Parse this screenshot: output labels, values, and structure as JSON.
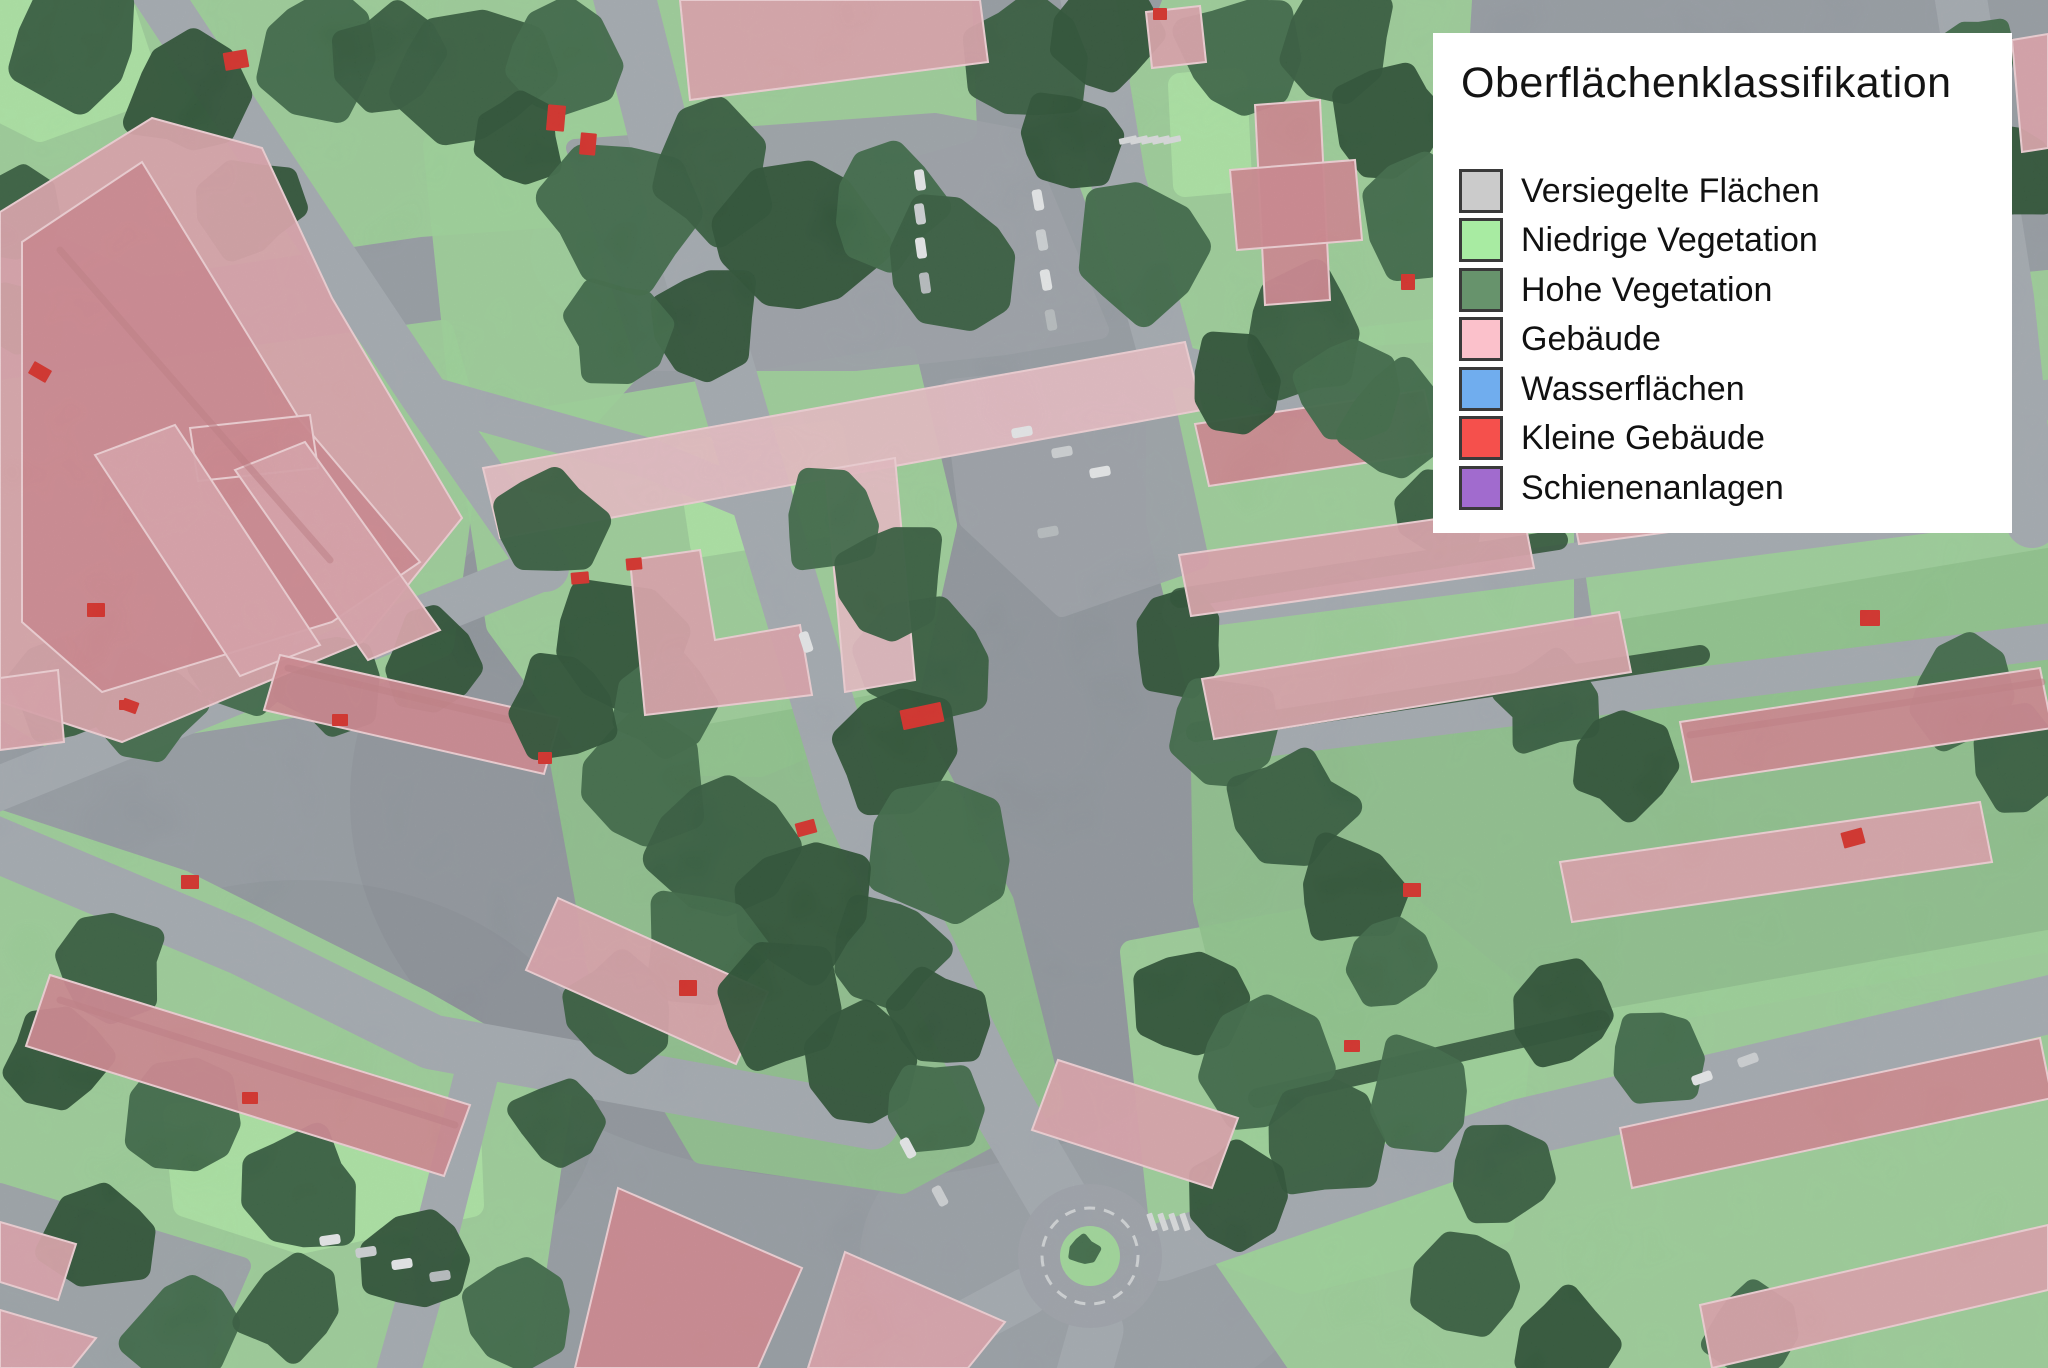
{
  "legend": {
    "title": "Oberflächenklassifikation",
    "items": [
      {
        "label": "Versiegelte Flächen",
        "color": "#CBCBCB"
      },
      {
        "label": "Niedrige Vegetation",
        "color": "#A8EBA2"
      },
      {
        "label": "Hohe Vegetation",
        "color": "#67936C"
      },
      {
        "label": "Gebäude",
        "color": "#FBC1CB"
      },
      {
        "label": "Wasserflächen",
        "color": "#70ADEE"
      },
      {
        "label": "Kleine Gebäude",
        "color": "#F5504C"
      },
      {
        "label": "Schienenanlagen",
        "color": "#A16BCE"
      }
    ]
  },
  "map": {
    "type": "landcover-classification-overlay",
    "class_colors": {
      "sealed_base": "#949BA2",
      "road": "#A3A9AF",
      "plaza": "#9CA2A8",
      "low_vegetation": "#9CD596",
      "low_vegetation_bright": "#ACE8A3",
      "low_vegetation_muted": "#8DC489",
      "high_vegetation": "#2C5635",
      "high_vegetation_dark": "#234A2C",
      "high_vegetation_light": "#366440",
      "building": "#DCA2AA",
      "building_light": "#E9BDC3",
      "building_roof": "#D0858D",
      "building_edge": "#F3D2D6",
      "roof_ridge": "#C27A82",
      "small_building": "#D7261F",
      "car_white": "#E9EBEC",
      "car_gray": "#CFD3D5",
      "car_dark": "#B8BDBF",
      "road_marking": "#DCDEDF",
      "roundabout_island": "#9FDB98"
    }
  }
}
